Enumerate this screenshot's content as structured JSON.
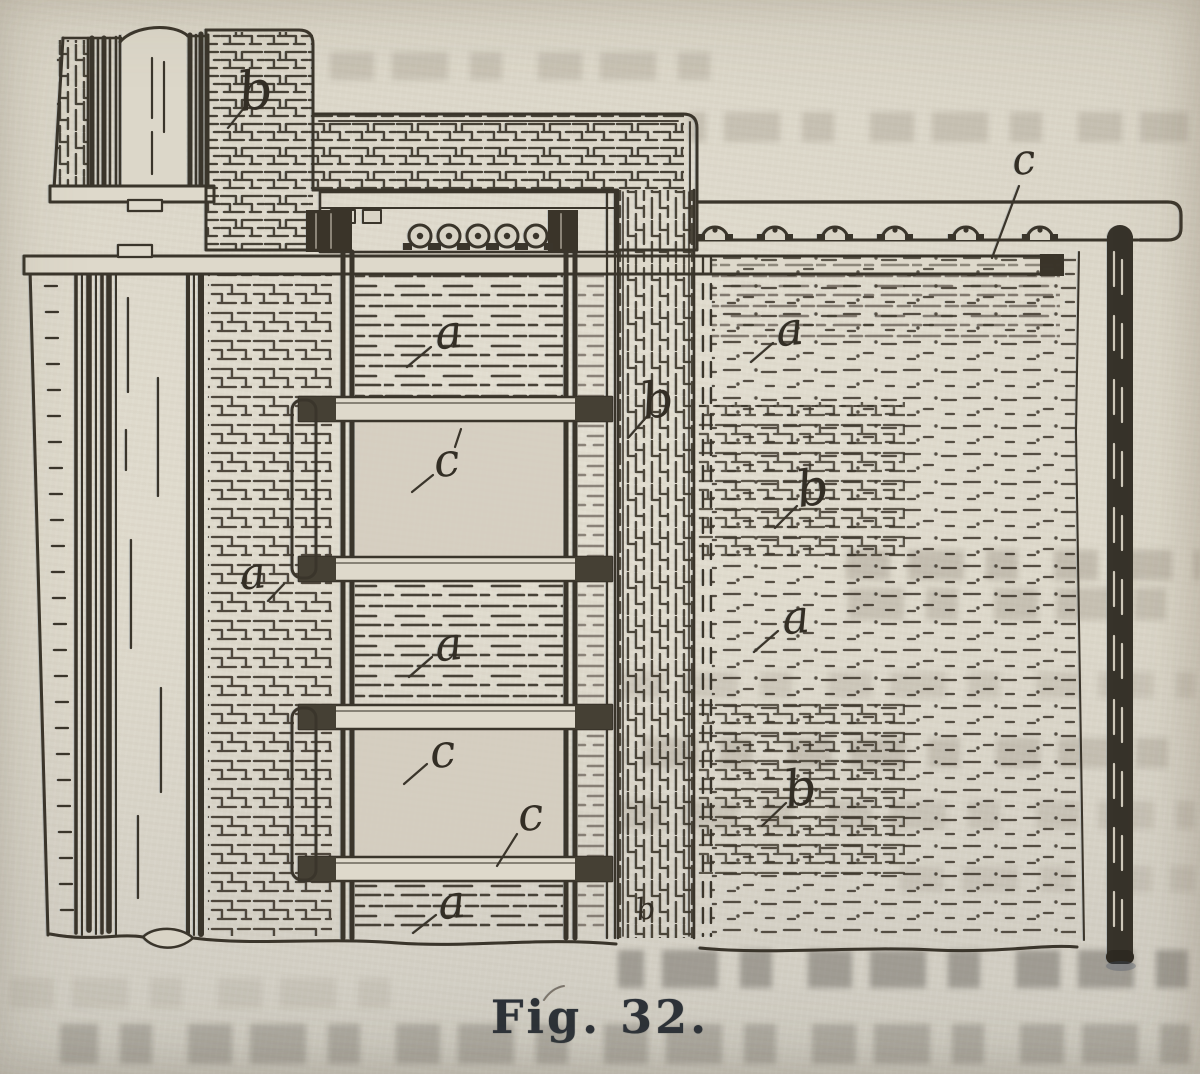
{
  "diagram": {
    "type": "engraving-cross-section",
    "caption": "Fig. 32.",
    "labels": [
      {
        "id": "b-masonry",
        "text": "b"
      },
      {
        "id": "c-rail",
        "text": "c"
      },
      {
        "id": "a-upper-center",
        "text": "a"
      },
      {
        "id": "c-panel-1",
        "text": "c"
      },
      {
        "id": "a-left-wall",
        "text": "a"
      },
      {
        "id": "a-right-upper",
        "text": "a"
      },
      {
        "id": "b-brick-pier",
        "text": "b"
      },
      {
        "id": "b-right-upper",
        "text": "b"
      },
      {
        "id": "a-mid-center",
        "text": "a"
      },
      {
        "id": "c-panel-2",
        "text": "c"
      },
      {
        "id": "c-panel-3",
        "text": "c"
      },
      {
        "id": "a-right-mid",
        "text": "a"
      },
      {
        "id": "b-right-lower",
        "text": "b"
      },
      {
        "id": "a-lower-center",
        "text": "a"
      },
      {
        "id": "b-pier-bottom",
        "text": "b"
      }
    ],
    "colors": {
      "paper": "#d7d2c4",
      "ink": "#3a352b",
      "caption_ink": "#2d3238"
    }
  }
}
